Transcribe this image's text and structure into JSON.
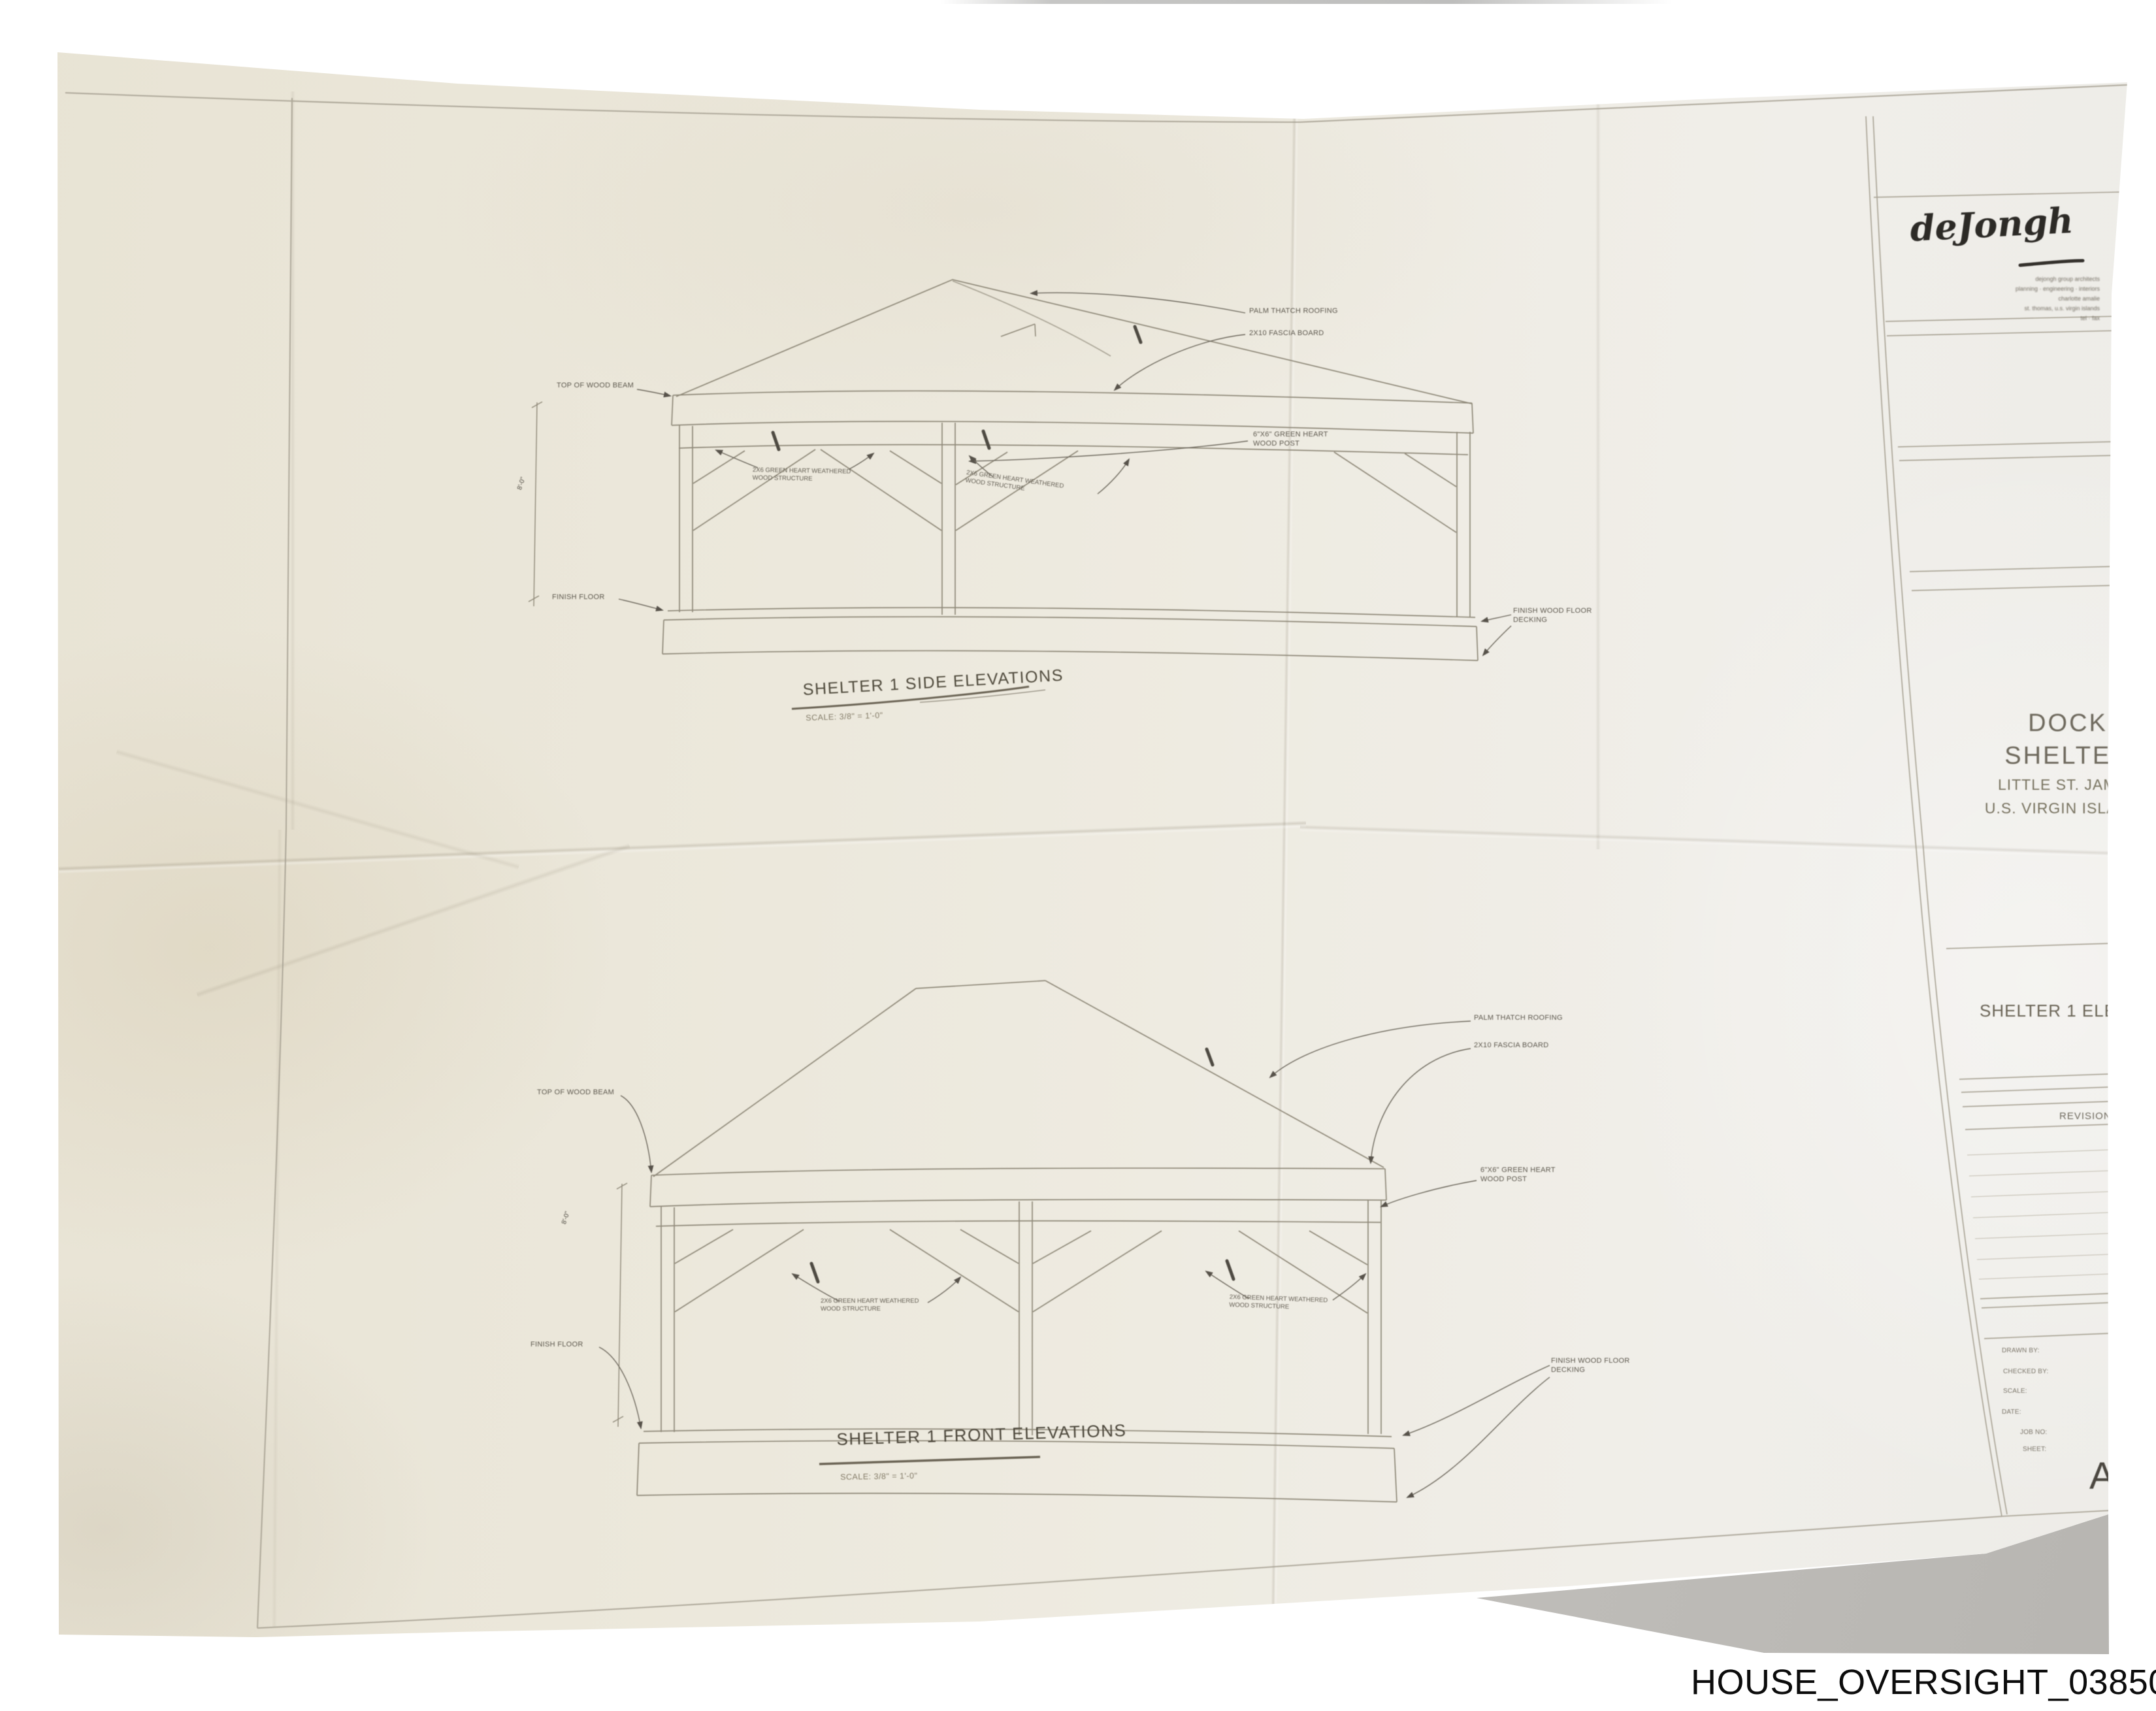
{
  "photo": {
    "watermark": "HOUSE_OVERSIGHT_038505"
  },
  "title_block": {
    "logo_script": "deJongh",
    "address_lines": [
      "dejongh group architects",
      "planning · engineering · interiors",
      "charlotte amalie",
      "st. thomas, u.s. virgin islands",
      "tel · fax"
    ],
    "project_lines": {
      "l1": "DOCK",
      "l2": "SHELTER",
      "l3": "LITTLE ST. JAMES",
      "l4": "U.S. VIRGIN ISLANDS"
    },
    "sheet_title": "SHELTER 1 ELEVATIONS",
    "revisions_header": "REVISIONS",
    "credits": [
      "DRAWN BY:",
      "CHECKED BY:",
      "SCALE:",
      "DATE:",
      "JOB NO:",
      "SHEET:"
    ],
    "sheet_letter": "A"
  },
  "side_elevation": {
    "title": "SHELTER 1 SIDE ELEVATIONS",
    "scale_note": "SCALE: 3/8\" = 1'-0\""
  },
  "front_elevation": {
    "title": "SHELTER 1 FRONT ELEVATIONS",
    "scale_note": "SCALE: 3/8\" = 1'-0\""
  },
  "annotations": {
    "top_of_beam": "TOP OF WOOD BEAM",
    "finish_floor": "FINISH FLOOR",
    "palm_thatch": "PALM THATCH ROOFING",
    "fascia_board": "2X10 FASCIA BOARD",
    "post_l1": "6\"X6\" GREEN HEART",
    "post_l2": "WOOD POST",
    "structure_l1": "2X6 GREEN HEART WEATHERED",
    "structure_l2": "WOOD STRUCTURE",
    "deck_l1": "FINISH WOOD FLOOR",
    "deck_l2": "DECKING",
    "height_dim": "8'-0\""
  }
}
